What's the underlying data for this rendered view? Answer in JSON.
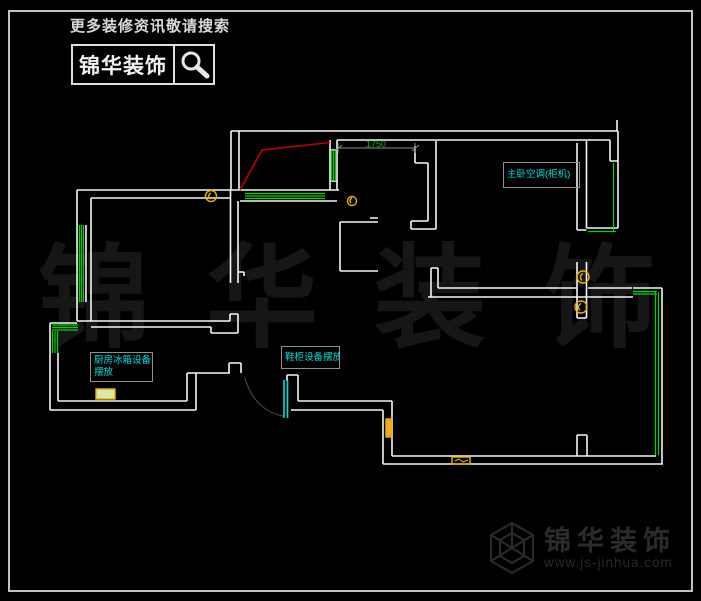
{
  "header": {
    "tagline": "更多装修资讯敬请搜索",
    "brand": "锦华装饰",
    "search_icon": "magnifier-icon"
  },
  "watermark": {
    "char1": "锦",
    "char2": "华",
    "char3": "装",
    "char4": "饰"
  },
  "floorplan": {
    "dimension_label": "1750",
    "annotations": [
      {
        "id": "bedroom-ac",
        "text": "主卧空调(柜机)"
      },
      {
        "id": "kitchen-fridge",
        "line1": "厨房冰箱设备",
        "line2": "摆放"
      },
      {
        "id": "shoe-cabinet",
        "text": "鞋柜设备摆放"
      }
    ],
    "colors": {
      "wall": "#f5f5f5",
      "window": "#00d600",
      "red_guide": "#c40000",
      "door": "#00e0e0",
      "symbol": "#e6b400",
      "label_text": "#00dede",
      "label_border": "#8f8f8f",
      "dimension_line": "#8c8c8c",
      "dimension_text": "#00b800"
    }
  },
  "footer": {
    "brand": "锦华装饰",
    "url": "www.js-jinhua.com",
    "logo_icon": "hex-cube-icon"
  }
}
